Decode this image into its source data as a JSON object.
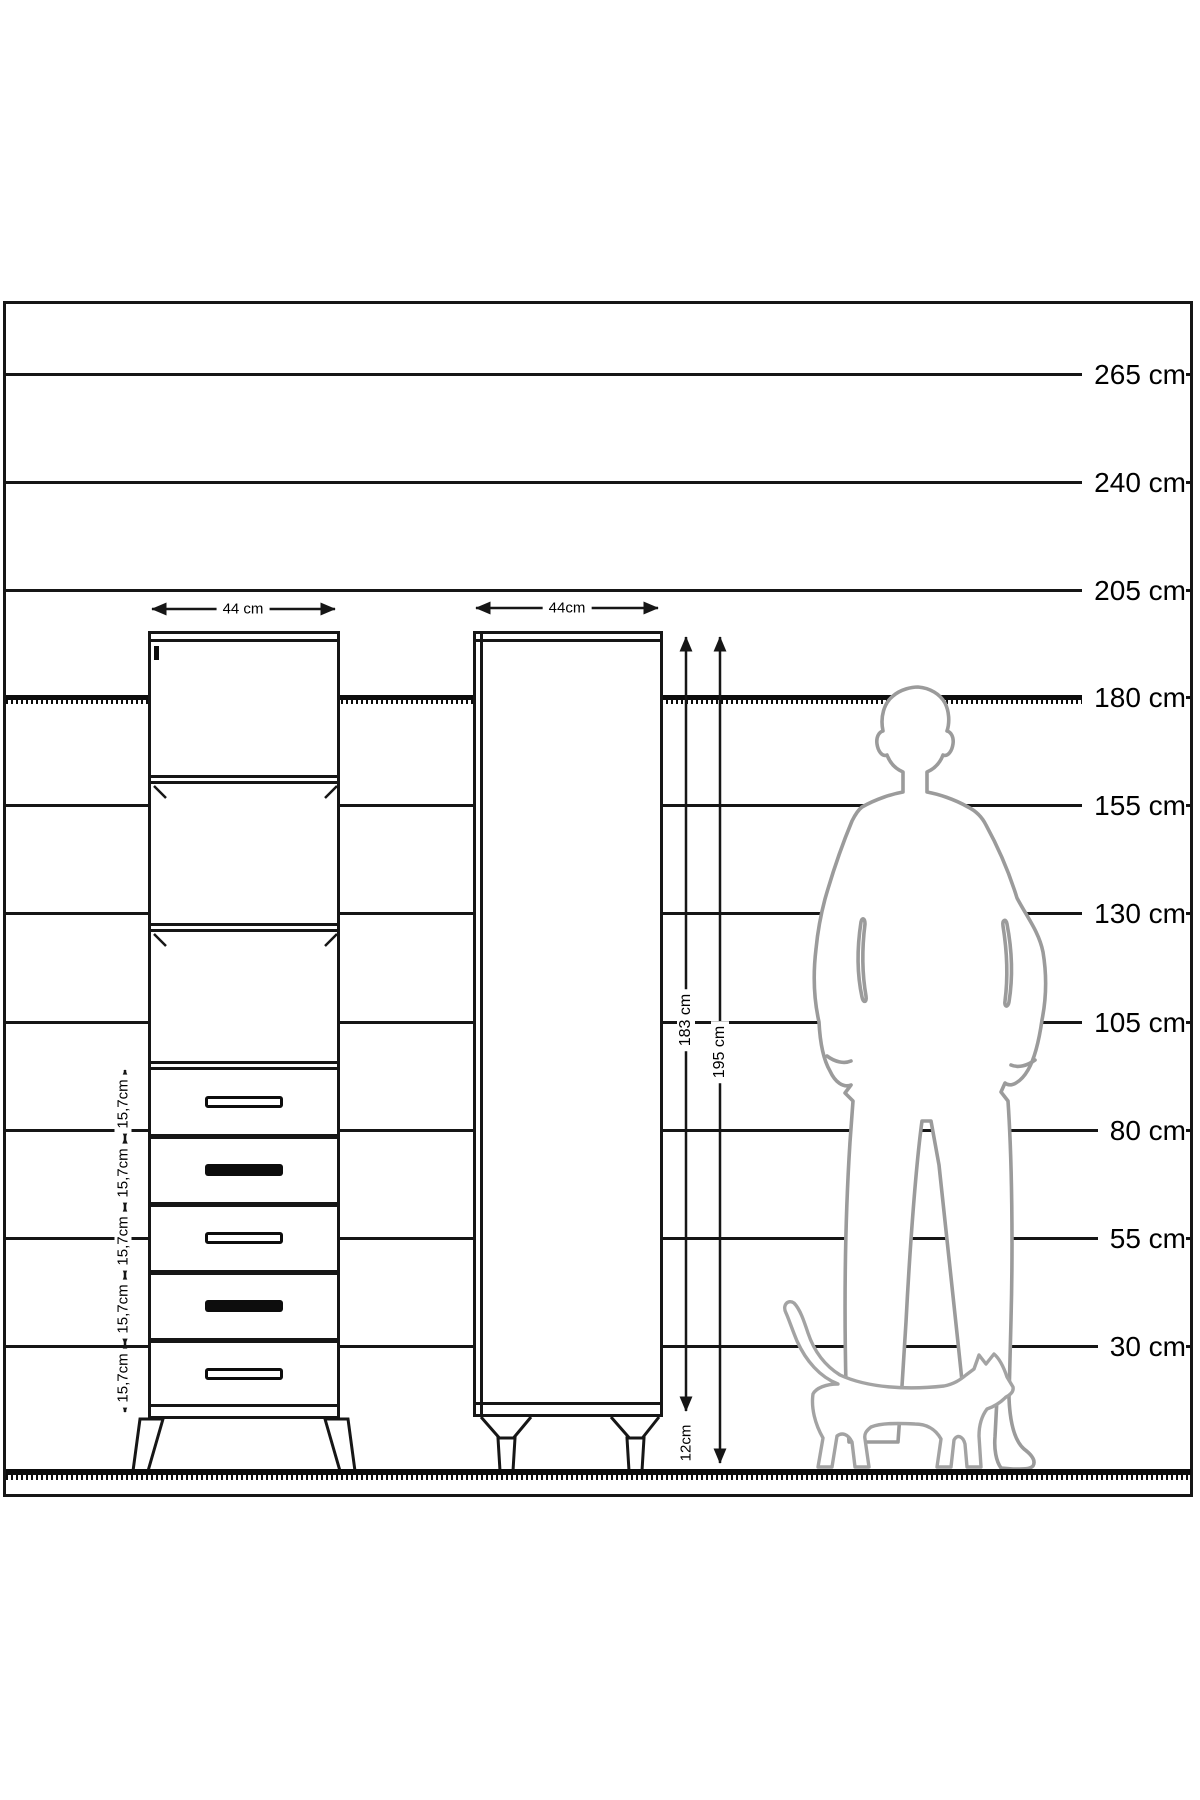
{
  "diagram": {
    "unit": "cm",
    "scale_lines": [
      {
        "label": "265 cm",
        "y": 373,
        "hatched": false
      },
      {
        "label": "240 cm",
        "y": 481,
        "hatched": false
      },
      {
        "label": "205 cm",
        "y": 589,
        "hatched": false
      },
      {
        "label": "180 cm",
        "y": 696,
        "hatched": true
      },
      {
        "label": "155 cm",
        "y": 804,
        "hatched": false
      },
      {
        "label": "130 cm",
        "y": 912,
        "hatched": false
      },
      {
        "label": "105 cm",
        "y": 1021,
        "hatched": false
      },
      {
        "label": "80 cm",
        "y": 1129,
        "hatched": false
      },
      {
        "label": "55 cm",
        "y": 1237,
        "hatched": false
      },
      {
        "label": "30 cm",
        "y": 1345,
        "hatched": false
      }
    ],
    "front_view": {
      "width_label": "44 cm",
      "shelf_count": 3,
      "drawers": [
        {
          "label": "15,7cm",
          "handle": "outline"
        },
        {
          "label": "15,7cm",
          "handle": "solid"
        },
        {
          "label": "15,7cm",
          "handle": "outline"
        },
        {
          "label": "15,7cm",
          "handle": "solid"
        },
        {
          "label": "15,7cm",
          "handle": "outline"
        }
      ]
    },
    "side_view": {
      "width_label": "44cm",
      "body_height_label": "183 cm",
      "total_height_label": "195 cm",
      "leg_height_label": "12cm"
    },
    "colors": {
      "line": "#161616",
      "person_outline": "#9b9b9b",
      "cat_outline": "#a3a3a3"
    }
  }
}
